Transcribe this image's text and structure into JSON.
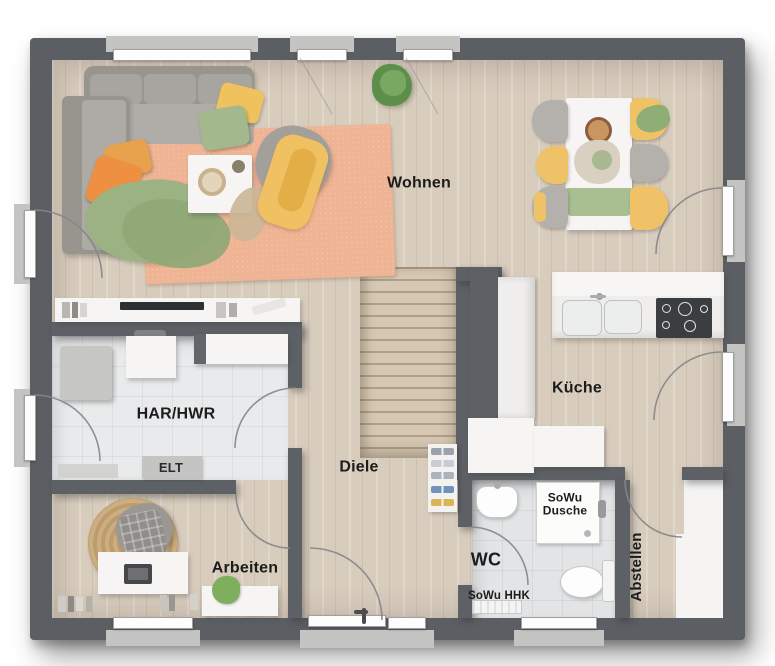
{
  "floor_plan": {
    "rooms": {
      "wohnen": {
        "label": "Wohnen"
      },
      "kueche": {
        "label": "Küche"
      },
      "har_hwr": {
        "label": "HAR/HWR"
      },
      "diele": {
        "label": "Diele"
      },
      "arbeiten": {
        "label": "Arbeiten"
      },
      "wc": {
        "label": "WC"
      },
      "abstellen": {
        "label": "Abstellen"
      }
    },
    "annotations": {
      "elt": "ELT",
      "sowu_dusche_line1": "SoWu",
      "sowu_dusche_line2": "Dusche",
      "sowu_hhk": "SoWu HHK"
    },
    "colors": {
      "wall": "#5b5f63",
      "wood_floor": "#d8ccbd",
      "tile_floor": "#e9eaeb",
      "rug_living": "#efb494",
      "rug_jute": "#c8a87b",
      "sofa_gray": "#a5a29e",
      "pillow_orange": "#ef8f41",
      "pillow_yellow": "#f0c25e",
      "pillow_green": "#a3b88c",
      "cooktop_black": "#3b3e41",
      "window_white": "#fdfdfd"
    }
  }
}
